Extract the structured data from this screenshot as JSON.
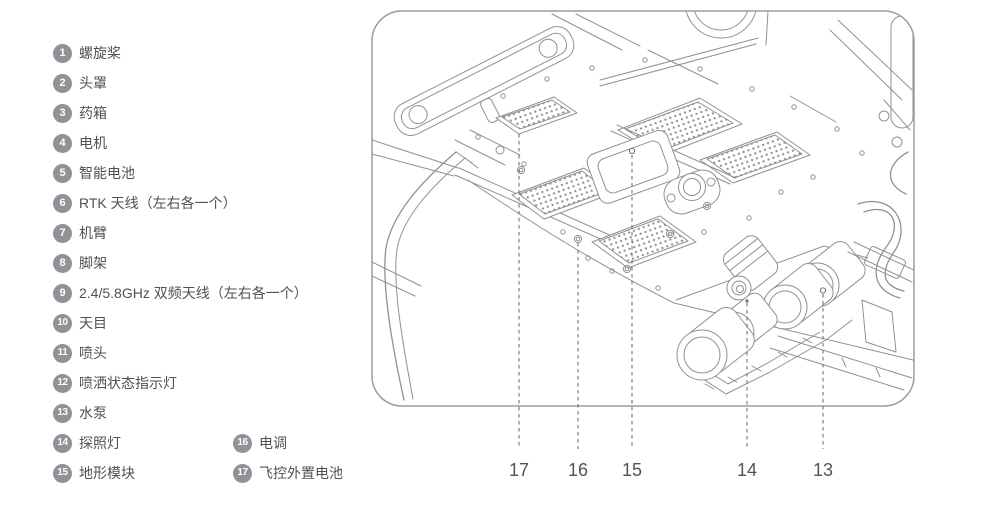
{
  "parts_list": {
    "items": [
      {
        "num": "1",
        "label": "螺旋桨"
      },
      {
        "num": "2",
        "label": "头罩"
      },
      {
        "num": "3",
        "label": "药箱"
      },
      {
        "num": "4",
        "label": "电机"
      },
      {
        "num": "5",
        "label": "智能电池"
      },
      {
        "num": "6",
        "label": "RTK 天线（左右各一个）"
      },
      {
        "num": "7",
        "label": "机臂"
      },
      {
        "num": "8",
        "label": "脚架"
      },
      {
        "num": "9",
        "label": "2.4/5.8GHz 双频天线（左右各一个）"
      },
      {
        "num": "10",
        "label": "天目"
      },
      {
        "num": "11",
        "label": "喷头"
      },
      {
        "num": "12",
        "label": "喷洒状态指示灯"
      },
      {
        "num": "13",
        "label": "水泵"
      },
      {
        "num": "14",
        "label": "探照灯"
      },
      {
        "num": "15",
        "label": "地形模块"
      },
      {
        "num": "16",
        "label": "电调"
      },
      {
        "num": "17",
        "label": "飞控外置电池"
      }
    ]
  },
  "diagram": {
    "description": "等轴测线稿：无人机底部视图",
    "callouts": [
      {
        "label": "17"
      },
      {
        "label": "16"
      },
      {
        "label": "15"
      },
      {
        "label": "14"
      },
      {
        "label": "13"
      }
    ]
  },
  "colors": {
    "badge": "#8f9296",
    "text": "#4d5155",
    "stroke": "#8e9194",
    "frame": "#9a9da0",
    "dash": "#6e7275",
    "callout": "#515559"
  }
}
